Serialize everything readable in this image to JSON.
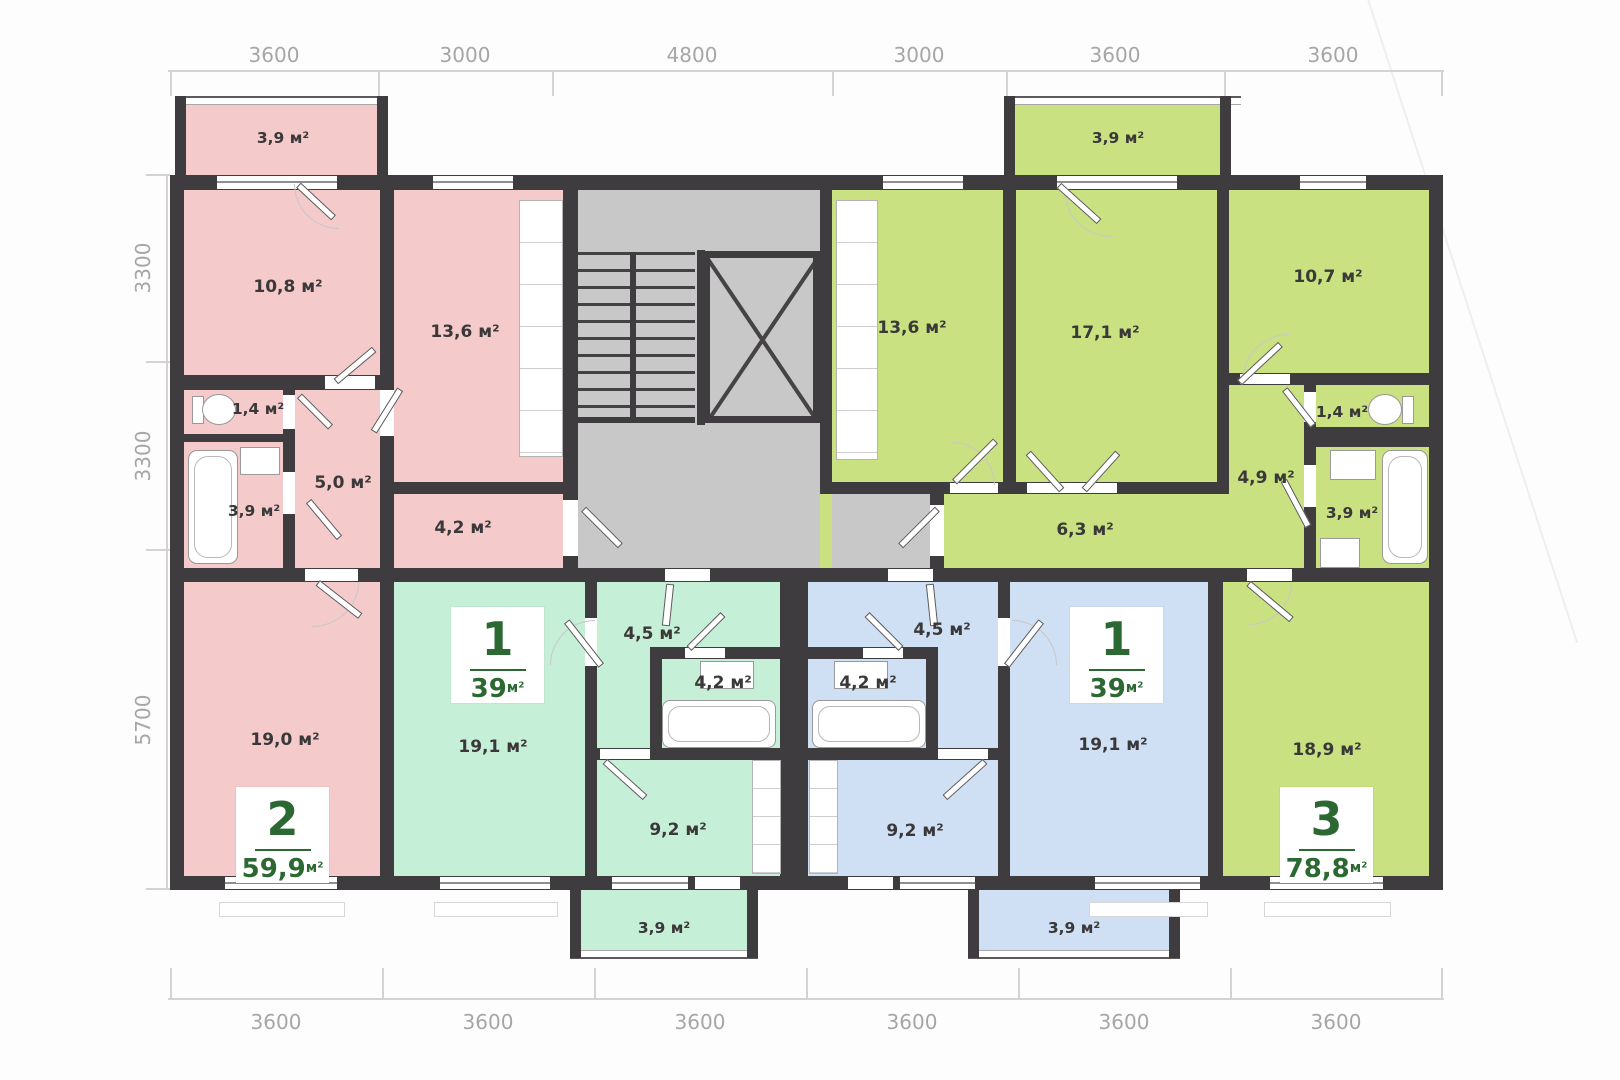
{
  "dimensions": {
    "top": [
      "3600",
      "3000",
      "4800",
      "3000",
      "3600",
      "3600"
    ],
    "left": [
      "3300",
      "3300",
      "5700"
    ],
    "bottom": [
      "3600",
      "3600",
      "3600",
      "3600",
      "3600",
      "3600"
    ]
  },
  "apartments": {
    "pink": {
      "badge": {
        "number": "2",
        "area": "59,9",
        "unit": "м²"
      },
      "labels": {
        "balcony": "3,9 м²",
        "bedroom": "10,8 м²",
        "kitchen": "13,6 м²",
        "wc": "1,4 м²",
        "hall": "5,0 м²",
        "bath": "3,9 м²",
        "corridor": "4,2 м²",
        "living": "19,0 м²"
      }
    },
    "mint": {
      "badge": {
        "number": "1",
        "area": "39",
        "unit": "м²"
      },
      "labels": {
        "living": "19,1 м²",
        "hall": "4,5 м²",
        "bath": "4,2 м²",
        "kitchen": "9,2 м²",
        "balcony": "3,9 м²"
      }
    },
    "blue": {
      "badge": {
        "number": "1",
        "area": "39",
        "unit": "м²"
      },
      "labels": {
        "hall": "4,5 м²",
        "bath": "4,2 м²",
        "living": "19,1 м²",
        "kitchen": "9,2 м²",
        "balcony": "3,9 м²"
      }
    },
    "green": {
      "badge": {
        "number": "3",
        "area": "78,8",
        "unit": "м²"
      },
      "labels": {
        "balcony": "3,9 м²",
        "kitchen": "13,6 м²",
        "living": "17,1 м²",
        "bedroom": "10,7 м²",
        "wc": "1,4 м²",
        "hall": "4,9 м²",
        "bath": "3,9 м²",
        "corridor": "6,3 м²",
        "bedroom2": "18,9 м²"
      }
    }
  },
  "colors": {
    "pink": "#f4caca",
    "mint": "#c6efd7",
    "blue": "#cfdff4",
    "green": "#c9e180",
    "wall": "#3e3c3e",
    "core": "#c9c8c8",
    "badge_green": "#2c6832",
    "dim_text": "#a8a5a5",
    "label_text": "#3a3839"
  }
}
